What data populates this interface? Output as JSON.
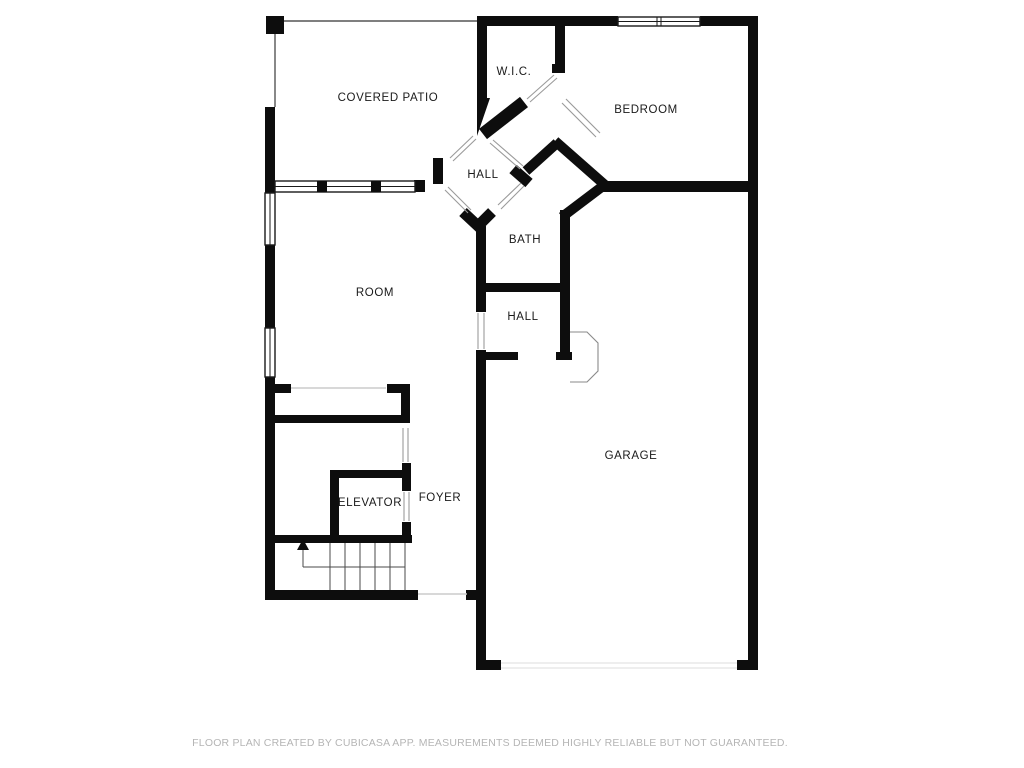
{
  "floor_plan": {
    "rooms": [
      {
        "id": "covered-patio",
        "label": "COVERED PATIO"
      },
      {
        "id": "wic",
        "label": "W.I.C."
      },
      {
        "id": "bedroom",
        "label": "BEDROOM"
      },
      {
        "id": "hall-upper",
        "label": "HALL"
      },
      {
        "id": "bath",
        "label": "BATH"
      },
      {
        "id": "hall-lower",
        "label": "HALL"
      },
      {
        "id": "room",
        "label": "ROOM"
      },
      {
        "id": "garage",
        "label": "GARAGE"
      },
      {
        "id": "elevator",
        "label": "ELEVATOR"
      },
      {
        "id": "foyer",
        "label": "FOYER"
      }
    ],
    "footer": "FLOOR PLAN CREATED BY CUBICASA APP. MEASUREMENTS DEEMED HIGHLY RELIABLE BUT NOT GUARANTEED.",
    "colors": {
      "wall": "#0d0d0d",
      "background": "#ffffff",
      "label": "#1a1a1a",
      "footer_text": "#b5b5b5",
      "opening_line": "#9a9a9a"
    }
  }
}
